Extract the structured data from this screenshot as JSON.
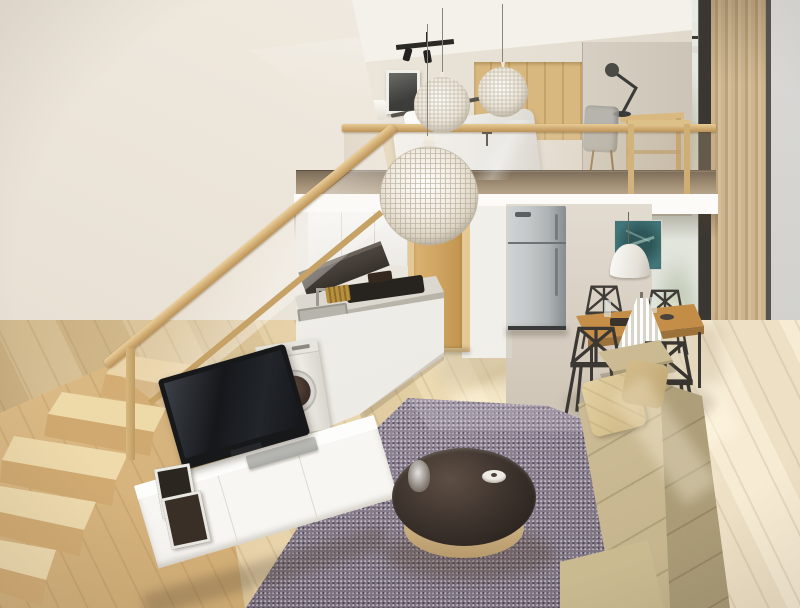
{
  "meta": {
    "type": "interior-3d-render",
    "view": "Loft studio apartment seen from an elevated corner: mezzanine bedroom above a kitchen, dining corner by a window wall, living area with rug, round coffee table, sofa, TV unit and a wooden staircase with glass balustrade"
  },
  "objects": [
    {
      "name": "staircase",
      "desc": "light oak stairs with glass balustrade and wood handrail"
    },
    {
      "name": "mezzanine",
      "desc": "upper sleeping loft with white fascia and glass railing"
    },
    {
      "name": "bed",
      "desc": "double bed with white duvet and pillows"
    },
    {
      "name": "wardrobe",
      "desc": "light wood panel wardrobe behind bed"
    },
    {
      "name": "framed-picture",
      "desc": "black and white art print on bedroom wall"
    },
    {
      "name": "table-lamp-bedroom",
      "desc": "white shade lamp on wooden sideboard"
    },
    {
      "name": "desk",
      "desc": "wood framed desk with black articulated lamp"
    },
    {
      "name": "desk-chair",
      "desc": "gray chair at mezzanine desk"
    },
    {
      "name": "track-light",
      "desc": "black ceiling track spotlights"
    },
    {
      "name": "pendant-spheres",
      "desc": "three white woven-wire globe pendant lamps"
    },
    {
      "name": "kitchen",
      "desc": "white cabinets, hood, cooktop, sink under the stairs"
    },
    {
      "name": "washing-machine",
      "desc": "white front-load washer with round dark door"
    },
    {
      "name": "door",
      "desc": "light oak interior door"
    },
    {
      "name": "fridge",
      "desc": "stainless steel top-freezer refrigerator"
    },
    {
      "name": "dining-set",
      "desc": "wood table, four dark wireframe chairs, pleated white table lamp"
    },
    {
      "name": "dome-pendant",
      "desc": "white dome pendant over dining table"
    },
    {
      "name": "artwork-teal",
      "desc": "teal botanical print on dining wall"
    },
    {
      "name": "window-wall",
      "desc": "full-height glazing with black frames and tan slat curtain"
    },
    {
      "name": "rug",
      "desc": "mottled purple-gray area rug"
    },
    {
      "name": "coffee-table",
      "desc": "round table, dark top on light wood base, glass vase and dish"
    },
    {
      "name": "sofa",
      "desc": "beige fabric sofa with cushions"
    },
    {
      "name": "tv-unit",
      "desc": "low white media console with flat TV, silver player, leaning frames"
    },
    {
      "name": "floor",
      "desc": "light oak plank floor with sunlight patches"
    }
  ],
  "colors": {
    "wall": "#ece5da",
    "wall2": "#ddd4c5",
    "ceil": "#f4f1ea",
    "wood": "#d7b57e",
    "wood2": "#bd9a60",
    "wood3": "#ecd4a4",
    "floor": "#e5cfa3",
    "floor2": "#cdb384",
    "floor3": "#f6ead0",
    "white": "#f7f6f3",
    "fascia": "#fcfbf8",
    "steel": "#c3c7c8",
    "steel2": "#8e9496",
    "door": "#d2a765",
    "doorframe": "#e5c994",
    "rug": "#8b8090",
    "rug2": "#6e6470",
    "rug3": "#b7afba",
    "sofa": "#d3c39d",
    "sofa2": "#b3a37d",
    "sofa3": "#e6d9b4",
    "ttop": "#39302a",
    "teal": "#417579",
    "chair": "#3f3b37",
    "curtain": "#cdb590",
    "curtain2": "#bda379",
    "winout": "#e7eae3",
    "green": "#7f9470",
    "frameblk": "#3a3732",
    "graywall": "#dad9d6",
    "glasstint": "rgba(205,180,140,0.38)"
  }
}
